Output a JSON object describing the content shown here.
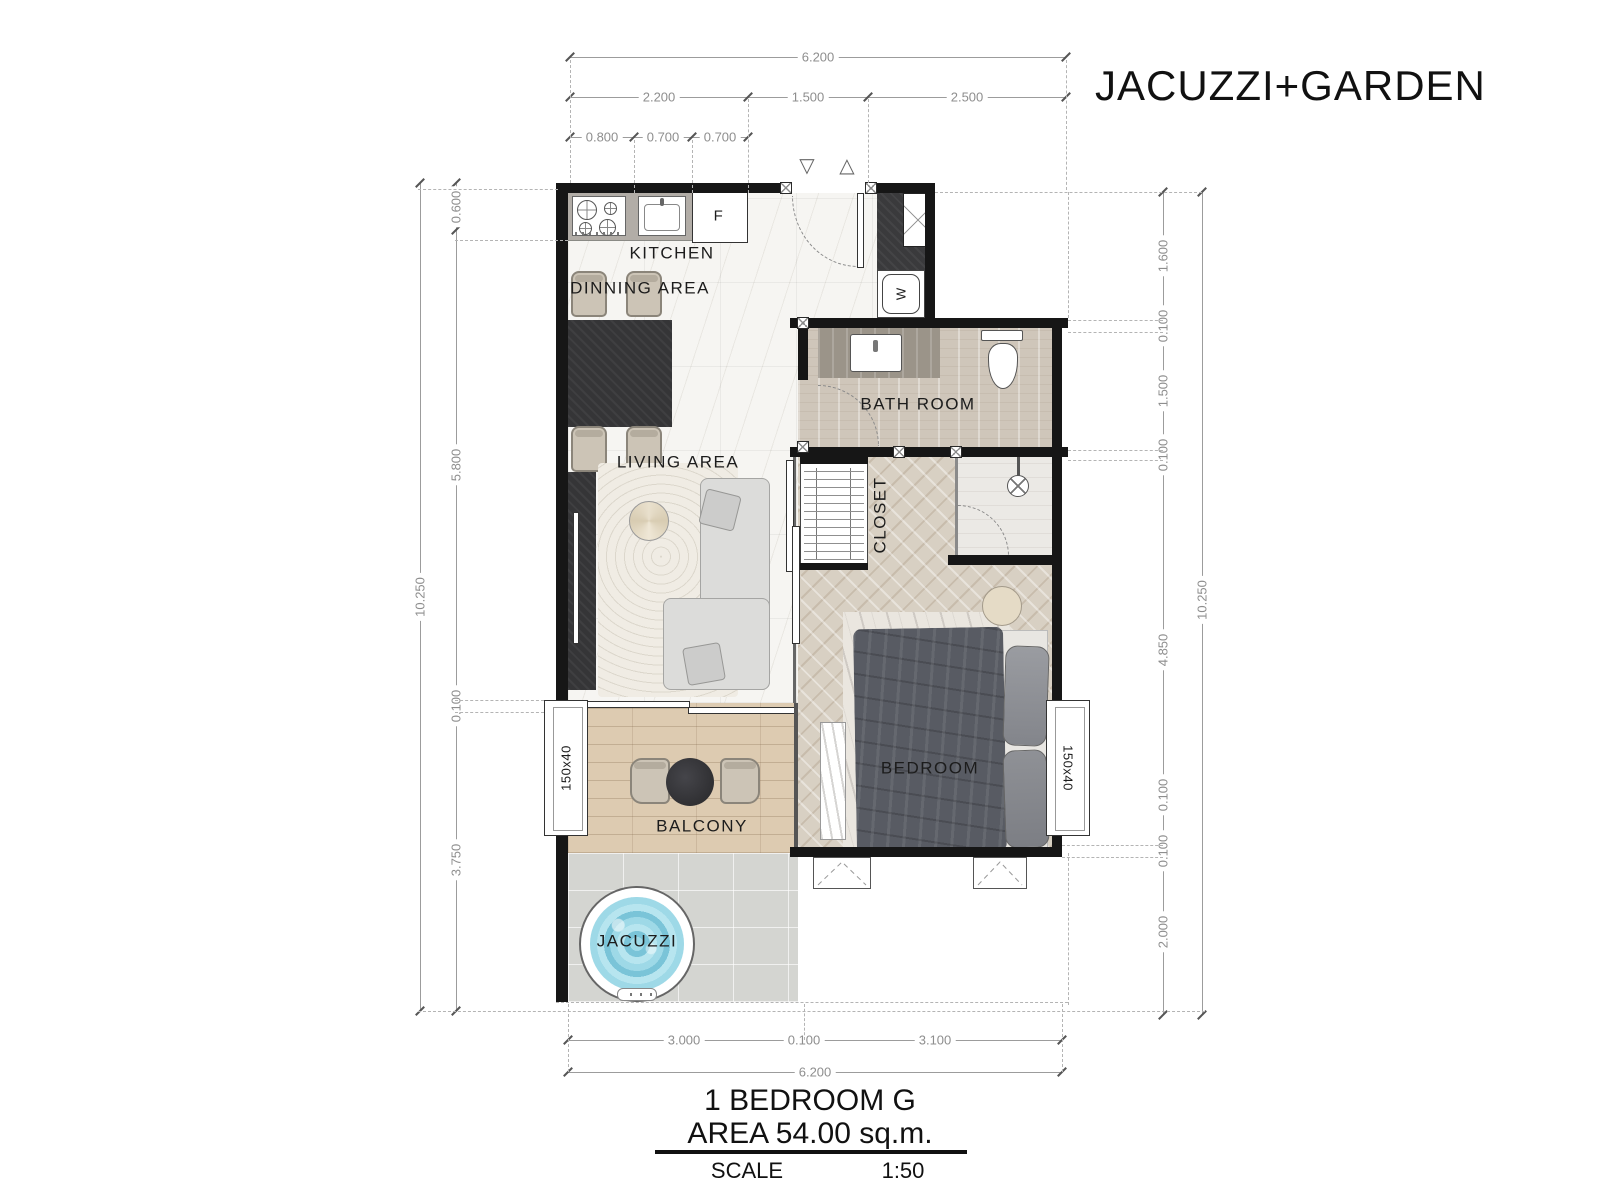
{
  "header": {
    "title": "JACUZZI+GARDEN"
  },
  "rooms": {
    "kitchen": "KITCHEN",
    "dining": "DINNING AREA",
    "living": "LIVING AREA",
    "bathroom": "BATH ROOM",
    "closet": "CLOSET",
    "bedroom": "BEDROOM",
    "balcony": "BALCONY",
    "jacuzzi": "JACUZZI"
  },
  "fixtures": {
    "fridge": "F",
    "washer": "W"
  },
  "windows": {
    "left": "150x40",
    "right": "150x40"
  },
  "icons": {
    "entry_triangle_down": "▽",
    "entry_triangle_up": "△"
  },
  "dimensions": {
    "top": {
      "total": "6.200",
      "segments": [
        "2.200",
        "1.500",
        "2.500"
      ],
      "details": [
        "0.800",
        "0.700",
        "0.700"
      ]
    },
    "bottom": {
      "segments": [
        "3.000",
        "0.100",
        "3.100"
      ],
      "total": "6.200"
    },
    "left": {
      "outer": "10.250",
      "segments": [
        "0.600",
        "5.800",
        "0.100",
        "3.750"
      ]
    },
    "right": {
      "outer": "10.250",
      "segments": [
        "1.600",
        "0.100",
        "1.500",
        "0.100",
        "4.850",
        "0.100",
        "0.100",
        "2.000"
      ]
    }
  },
  "title_block": {
    "unit": "1 BEDROOM G",
    "area": "AREA 54.00 sq.m.",
    "scale_label": "SCALE",
    "scale_value": "1:50"
  },
  "colors": {
    "wall": "#161616",
    "marble_floor": "#f6f5f2",
    "herringbone_floor": "#d8d0c3",
    "balcony_wood": "#ddcbb1",
    "garden_tile": "#d4d5d1",
    "bathroom_floor": "#cfc6ba",
    "water": "#8ed0e2",
    "dark_furniture": "#353537",
    "dim_text": "#8e8e8e"
  }
}
